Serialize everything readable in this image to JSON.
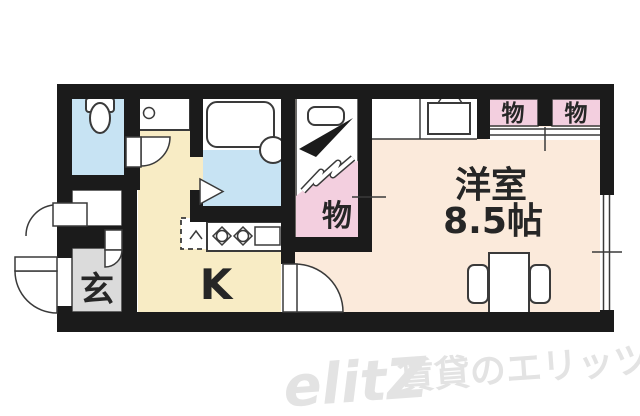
{
  "floor_plan": {
    "labels": {
      "entrance": "玄",
      "kitchen": "K",
      "western_room_name": "洋室",
      "western_room_size": "8.5帖",
      "closet": "物",
      "upper_closet_left": "物",
      "upper_closet_right": "物"
    },
    "watermark": {
      "logo": "elitZ",
      "caption": "賃貸のエリッツ"
    },
    "colors": {
      "wall_black": "#1b1b1b",
      "water_blue": "#c7e3f3",
      "kitchen_cream_yellow": "#f8ecc5",
      "western_room_peach": "#fbeadb",
      "closet_pink": "#f3cfdf",
      "entrance_gray": "#dbdbdb",
      "fixture_outline": "#3a3a3a",
      "label_text": "#262626",
      "watermark_gray": "#e3e3e3"
    }
  }
}
